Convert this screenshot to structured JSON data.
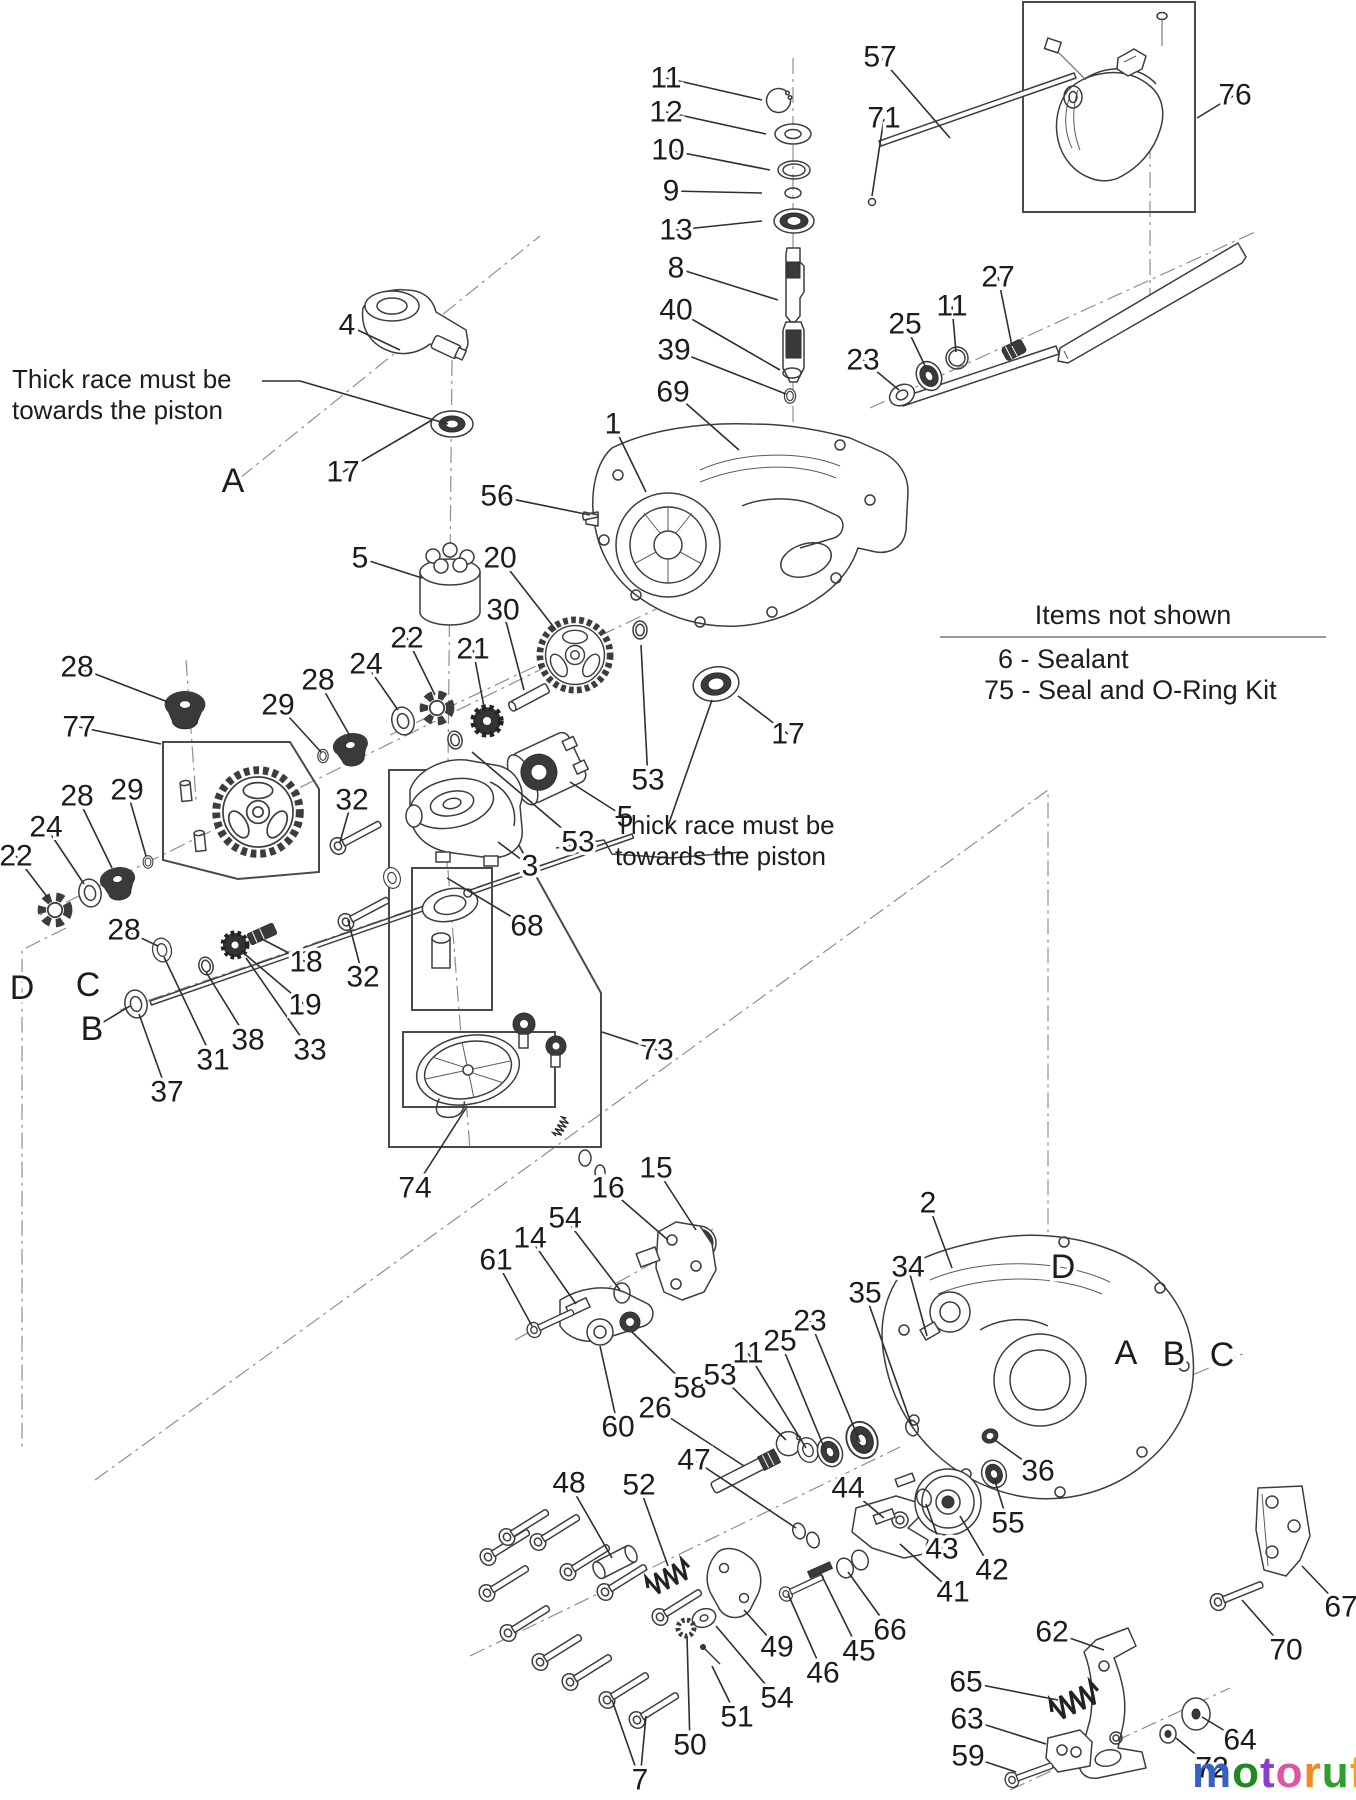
{
  "notes": {
    "thick_race_left": "Thick race must be\ntowards the piston",
    "thick_race_right": "Thick race must be\ntowards the piston"
  },
  "items_not_shown": {
    "title": "Items not shown",
    "items": [
      "6 - Sealant",
      "75 - Seal and O-Ring Kit"
    ]
  },
  "logo": {
    "word": [
      {
        "ch": "m",
        "c": "#3560c4"
      },
      {
        "ch": "o",
        "c": "#1f8a1f"
      },
      {
        "ch": "t",
        "c": "#8a3fd1"
      },
      {
        "ch": "o",
        "c": "#e0569e"
      },
      {
        "ch": "r",
        "c": "#ef8a1f"
      },
      {
        "ch": "u",
        "c": "#2f9e2f"
      },
      {
        "ch": "f",
        "c": "#f2a41f"
      }
    ],
    "suffix": ".de"
  },
  "labels": [
    {
      "t": "11",
      "x": 666,
      "y": 78,
      "lx": 762,
      "ly": 100
    },
    {
      "t": "12",
      "x": 666,
      "y": 112,
      "lx": 766,
      "ly": 134
    },
    {
      "t": "10",
      "x": 668,
      "y": 150,
      "lx": 770,
      "ly": 170
    },
    {
      "t": "9",
      "x": 671,
      "y": 191,
      "lx": 762,
      "ly": 193
    },
    {
      "t": "13",
      "x": 676,
      "y": 230,
      "lx": 762,
      "ly": 221
    },
    {
      "t": "8",
      "x": 676,
      "y": 268,
      "lx": 778,
      "ly": 300
    },
    {
      "t": "40",
      "x": 676,
      "y": 310,
      "lx": 780,
      "ly": 370
    },
    {
      "t": "39",
      "x": 674,
      "y": 350,
      "lx": 786,
      "ly": 394
    },
    {
      "t": "69",
      "x": 673,
      "y": 392,
      "lx": 739,
      "ly": 450
    },
    {
      "t": "57",
      "x": 880,
      "y": 57,
      "lx": 950,
      "ly": 138
    },
    {
      "t": "71",
      "x": 884,
      "y": 118,
      "lx": 872,
      "ly": 196
    },
    {
      "t": "76",
      "x": 1235,
      "y": 95,
      "lx": 1197,
      "ly": 118
    },
    {
      "t": "27",
      "x": 998,
      "y": 277,
      "lx": 1012,
      "ly": 346
    },
    {
      "t": "11",
      "x": 952,
      "y": 306,
      "lx": 956,
      "ly": 352
    },
    {
      "t": "25",
      "x": 905,
      "y": 324,
      "lx": 927,
      "ly": 370
    },
    {
      "t": "23",
      "x": 863,
      "y": 360,
      "lx": 899,
      "ly": 390
    },
    {
      "t": "1",
      "x": 613,
      "y": 424,
      "lx": 646,
      "ly": 492
    },
    {
      "t": "4",
      "x": 347,
      "y": 325,
      "lx": 400,
      "ly": 350
    },
    {
      "t": "A",
      "x": 233,
      "y": 481,
      "letter": true
    },
    {
      "t": "17",
      "x": 343,
      "y": 472,
      "lx": 432,
      "ly": 420
    },
    {
      "t": "56",
      "x": 497,
      "y": 496,
      "lx": 590,
      "ly": 515
    },
    {
      "t": "5",
      "x": 360,
      "y": 558,
      "lx": 422,
      "ly": 578
    },
    {
      "t": "20",
      "x": 500,
      "y": 558,
      "lx": 556,
      "ly": 630
    },
    {
      "t": "30",
      "x": 503,
      "y": 610,
      "lx": 524,
      "ly": 690
    },
    {
      "t": "22",
      "x": 407,
      "y": 638,
      "lx": 435,
      "ly": 695
    },
    {
      "t": "21",
      "x": 473,
      "y": 649,
      "lx": 484,
      "ly": 707
    },
    {
      "t": "24",
      "x": 366,
      "y": 664,
      "lx": 398,
      "ly": 710
    },
    {
      "t": "28",
      "x": 318,
      "y": 680,
      "lx": 350,
      "ly": 736
    },
    {
      "t": "29",
      "x": 278,
      "y": 705,
      "lx": 321,
      "ly": 752
    },
    {
      "t": "28",
      "x": 77,
      "y": 667,
      "lx": 168,
      "ly": 702
    },
    {
      "t": "77",
      "x": 79,
      "y": 727,
      "lx": 161,
      "ly": 744
    },
    {
      "t": "29",
      "x": 127,
      "y": 790,
      "lx": 146,
      "ly": 856
    },
    {
      "t": "28",
      "x": 77,
      "y": 796,
      "lx": 112,
      "ly": 868
    },
    {
      "t": "24",
      "x": 46,
      "y": 827,
      "lx": 84,
      "ly": 884
    },
    {
      "t": "22",
      "x": 16,
      "y": 856,
      "lx": 48,
      "ly": 898
    },
    {
      "t": "28",
      "x": 124,
      "y": 930,
      "lx": 158,
      "ly": 946
    },
    {
      "t": "D",
      "x": 22,
      "y": 988,
      "letter": true
    },
    {
      "t": "C",
      "x": 88,
      "y": 985,
      "letter": true
    },
    {
      "t": "B",
      "x": 92,
      "y": 1029,
      "lx": 130,
      "ly": 1006,
      "letter": true
    },
    {
      "t": "37",
      "x": 167,
      "y": 1092,
      "lx": 139,
      "ly": 1014
    },
    {
      "t": "31",
      "x": 213,
      "y": 1060,
      "lx": 164,
      "ly": 957
    },
    {
      "t": "38",
      "x": 248,
      "y": 1040,
      "lx": 206,
      "ly": 972
    },
    {
      "t": "33",
      "x": 310,
      "y": 1050,
      "lx": 246,
      "ly": 958
    },
    {
      "t": "19",
      "x": 305,
      "y": 1005,
      "lx": 240,
      "ly": 950
    },
    {
      "t": "18",
      "x": 306,
      "y": 962,
      "lx": 260,
      "ly": 938
    },
    {
      "t": "32",
      "x": 352,
      "y": 800,
      "lx": 340,
      "ly": 842
    },
    {
      "t": "32",
      "x": 363,
      "y": 977,
      "lx": 348,
      "ly": 920
    },
    {
      "t": "3",
      "x": 530,
      "y": 866,
      "lx": 498,
      "ly": 842
    },
    {
      "t": "68",
      "x": 527,
      "y": 926,
      "lx": 447,
      "ly": 878
    },
    {
      "t": "53",
      "x": 648,
      "y": 780,
      "lx": 641,
      "ly": 645
    },
    {
      "t": "5",
      "x": 625,
      "y": 817,
      "lx": 570,
      "ly": 782
    },
    {
      "t": "53",
      "x": 578,
      "y": 842,
      "lx": 472,
      "ly": 752
    },
    {
      "t": "17",
      "x": 788,
      "y": 734,
      "lx": 738,
      "ly": 696
    },
    {
      "t": "73",
      "x": 657,
      "y": 1050,
      "lx": 602,
      "ly": 1032
    },
    {
      "t": "74",
      "x": 415,
      "y": 1188,
      "lx": 466,
      "ly": 1108
    },
    {
      "t": "15",
      "x": 656,
      "y": 1168,
      "lx": 696,
      "ly": 1230
    },
    {
      "t": "16",
      "x": 608,
      "y": 1188,
      "lx": 668,
      "ly": 1240
    },
    {
      "t": "54",
      "x": 565,
      "y": 1218,
      "lx": 620,
      "ly": 1290
    },
    {
      "t": "14",
      "x": 530,
      "y": 1238,
      "lx": 576,
      "ly": 1304
    },
    {
      "t": "61",
      "x": 496,
      "y": 1260,
      "lx": 532,
      "ly": 1326
    },
    {
      "t": "60",
      "x": 618,
      "y": 1427,
      "lx": 600,
      "ly": 1346
    },
    {
      "t": "58",
      "x": 690,
      "y": 1388,
      "lx": 632,
      "ly": 1332
    },
    {
      "t": "53",
      "x": 720,
      "y": 1375,
      "lx": 786,
      "ly": 1440
    },
    {
      "t": "11",
      "x": 748,
      "y": 1353,
      "lx": 806,
      "ly": 1448
    },
    {
      "t": "25",
      "x": 780,
      "y": 1341,
      "lx": 826,
      "ly": 1452
    },
    {
      "t": "23",
      "x": 810,
      "y": 1321,
      "lx": 860,
      "ly": 1442
    },
    {
      "t": "26",
      "x": 655,
      "y": 1408,
      "lx": 744,
      "ly": 1466
    },
    {
      "t": "47",
      "x": 694,
      "y": 1460,
      "lx": 796,
      "ly": 1528
    },
    {
      "t": "48",
      "x": 569,
      "y": 1483,
      "lx": 612,
      "ly": 1558
    },
    {
      "t": "52",
      "x": 639,
      "y": 1485,
      "lx": 668,
      "ly": 1566
    },
    {
      "t": "44",
      "x": 848,
      "y": 1488,
      "lx": 884,
      "ly": 1518
    },
    {
      "t": "49",
      "x": 777,
      "y": 1647,
      "lx": 744,
      "ly": 1610
    },
    {
      "t": "46",
      "x": 823,
      "y": 1673,
      "lx": 788,
      "ly": 1594
    },
    {
      "t": "45",
      "x": 859,
      "y": 1651,
      "lx": 820,
      "ly": 1572
    },
    {
      "t": "66",
      "x": 890,
      "y": 1630,
      "lx": 848,
      "ly": 1572
    },
    {
      "t": "54",
      "x": 777,
      "y": 1698,
      "lx": 716,
      "ly": 1626
    },
    {
      "t": "51",
      "x": 737,
      "y": 1717,
      "lx": 712,
      "ly": 1666
    },
    {
      "t": "50",
      "x": 690,
      "y": 1745,
      "lx": 687,
      "ly": 1636
    },
    {
      "t": "7",
      "x": 640,
      "y": 1780,
      "lx": 612,
      "ly": 1700,
      "l2x": 646,
      "l2y": 1716
    },
    {
      "t": "2",
      "x": 928,
      "y": 1203,
      "lx": 952,
      "ly": 1268
    },
    {
      "t": "34",
      "x": 908,
      "y": 1267,
      "lx": 927,
      "ly": 1336
    },
    {
      "t": "35",
      "x": 865,
      "y": 1293,
      "lx": 912,
      "ly": 1426
    },
    {
      "t": "D",
      "x": 1063,
      "y": 1267,
      "letter": true
    },
    {
      "t": "A",
      "x": 1126,
      "y": 1353,
      "letter": true
    },
    {
      "t": "B",
      "x": 1174,
      "y": 1354,
      "letter": true
    },
    {
      "t": "C",
      "x": 1222,
      "y": 1355,
      "letter": true
    },
    {
      "t": "36",
      "x": 1038,
      "y": 1471,
      "lx": 992,
      "ly": 1438
    },
    {
      "t": "55",
      "x": 1008,
      "y": 1523,
      "lx": 994,
      "ly": 1478
    },
    {
      "t": "43",
      "x": 942,
      "y": 1549,
      "lx": 926,
      "ly": 1504
    },
    {
      "t": "42",
      "x": 992,
      "y": 1570,
      "lx": 960,
      "ly": 1516
    },
    {
      "t": "41",
      "x": 953,
      "y": 1592,
      "lx": 900,
      "ly": 1544
    },
    {
      "t": "62",
      "x": 1052,
      "y": 1632,
      "lx": 1104,
      "ly": 1650
    },
    {
      "t": "65",
      "x": 966,
      "y": 1682,
      "lx": 1058,
      "ly": 1700
    },
    {
      "t": "63",
      "x": 967,
      "y": 1719,
      "lx": 1046,
      "ly": 1744
    },
    {
      "t": "59",
      "x": 968,
      "y": 1756,
      "lx": 1016,
      "ly": 1772
    },
    {
      "t": "64",
      "x": 1240,
      "y": 1740,
      "lx": 1202,
      "ly": 1717
    },
    {
      "t": "72",
      "x": 1212,
      "y": 1768,
      "lx": 1176,
      "ly": 1738
    },
    {
      "t": "67",
      "x": 1341,
      "y": 1607,
      "lx": 1302,
      "ly": 1566
    },
    {
      "t": "70",
      "x": 1286,
      "y": 1650,
      "lx": 1242,
      "ly": 1600
    }
  ]
}
